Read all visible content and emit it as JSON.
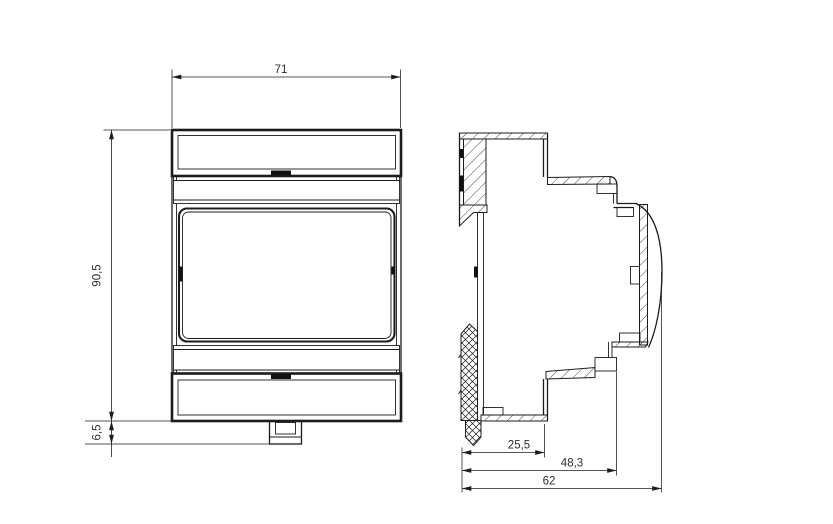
{
  "drawing": {
    "background": "#ffffff",
    "line_color": "#1c1c1c",
    "dim_text_color": "#2d2d2d"
  },
  "dims": {
    "front_width": "71",
    "front_height": "90,5",
    "clip_offset": "6,5",
    "side_depth_inner": "25,5",
    "side_depth_mid": "48,3",
    "side_depth_total": "62"
  }
}
